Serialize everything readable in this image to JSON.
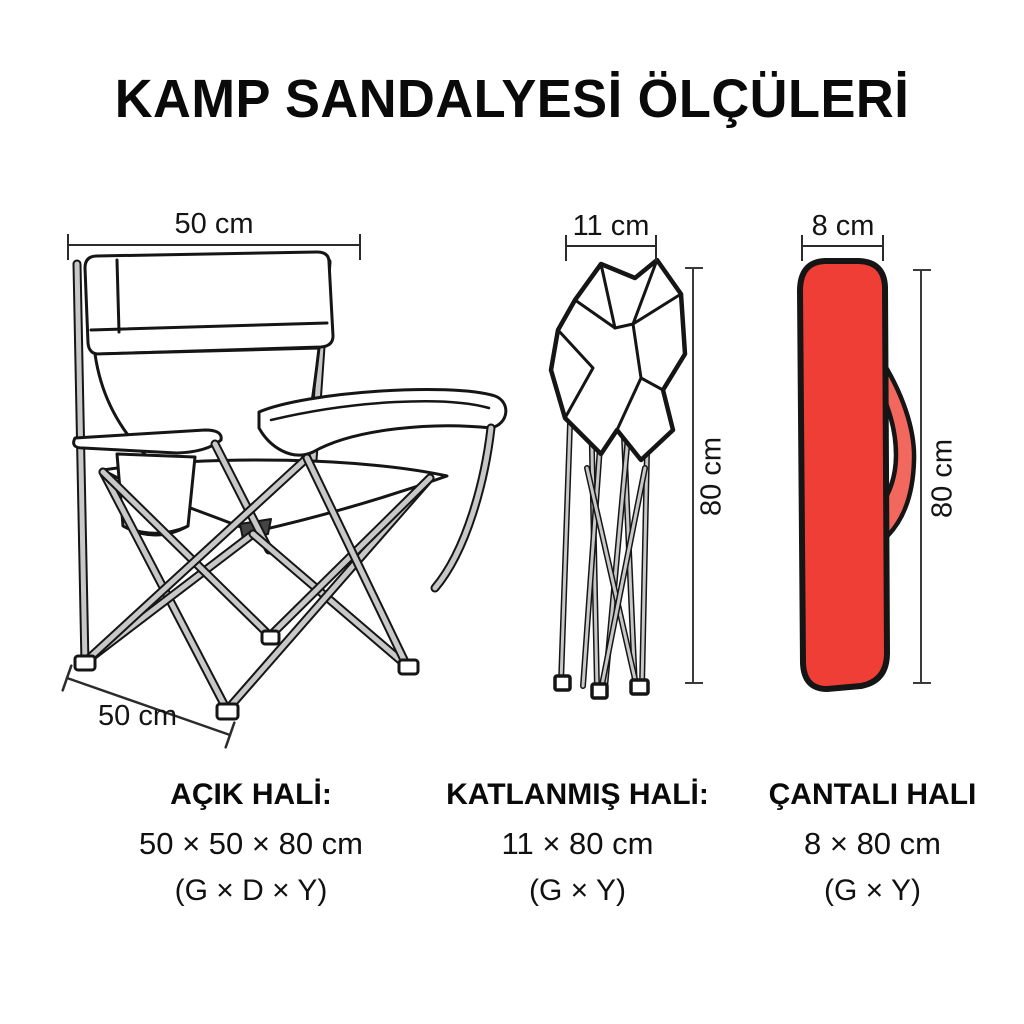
{
  "title": "KAMP SANDALYESİ ÖLÇÜLERİ",
  "colors": {
    "bag_red": "#ee3e36",
    "bag_strap": "#f2685e",
    "outline": "#151515",
    "tube_gray": "#c8c8c8",
    "dim_line": "#2b2b2b"
  },
  "dims": {
    "chair_width": "50 cm",
    "chair_depth": "50 cm",
    "folded_width": "11 cm",
    "folded_height": "80 cm",
    "bag_width": "8 cm",
    "bag_height": "80 cm"
  },
  "captions": {
    "open": {
      "title": "AÇIK HALİ:",
      "size": "50 × 50 × 80 cm",
      "axes": "(G × D × Y)"
    },
    "folded": {
      "title": "KATLANMIŞ HALİ:",
      "size": "11 × 80 cm",
      "axes": "(G × Y)"
    },
    "bag": {
      "title": "ÇANTALI HALI",
      "size": "8 × 80 cm",
      "axes": "(G × Y)"
    }
  }
}
